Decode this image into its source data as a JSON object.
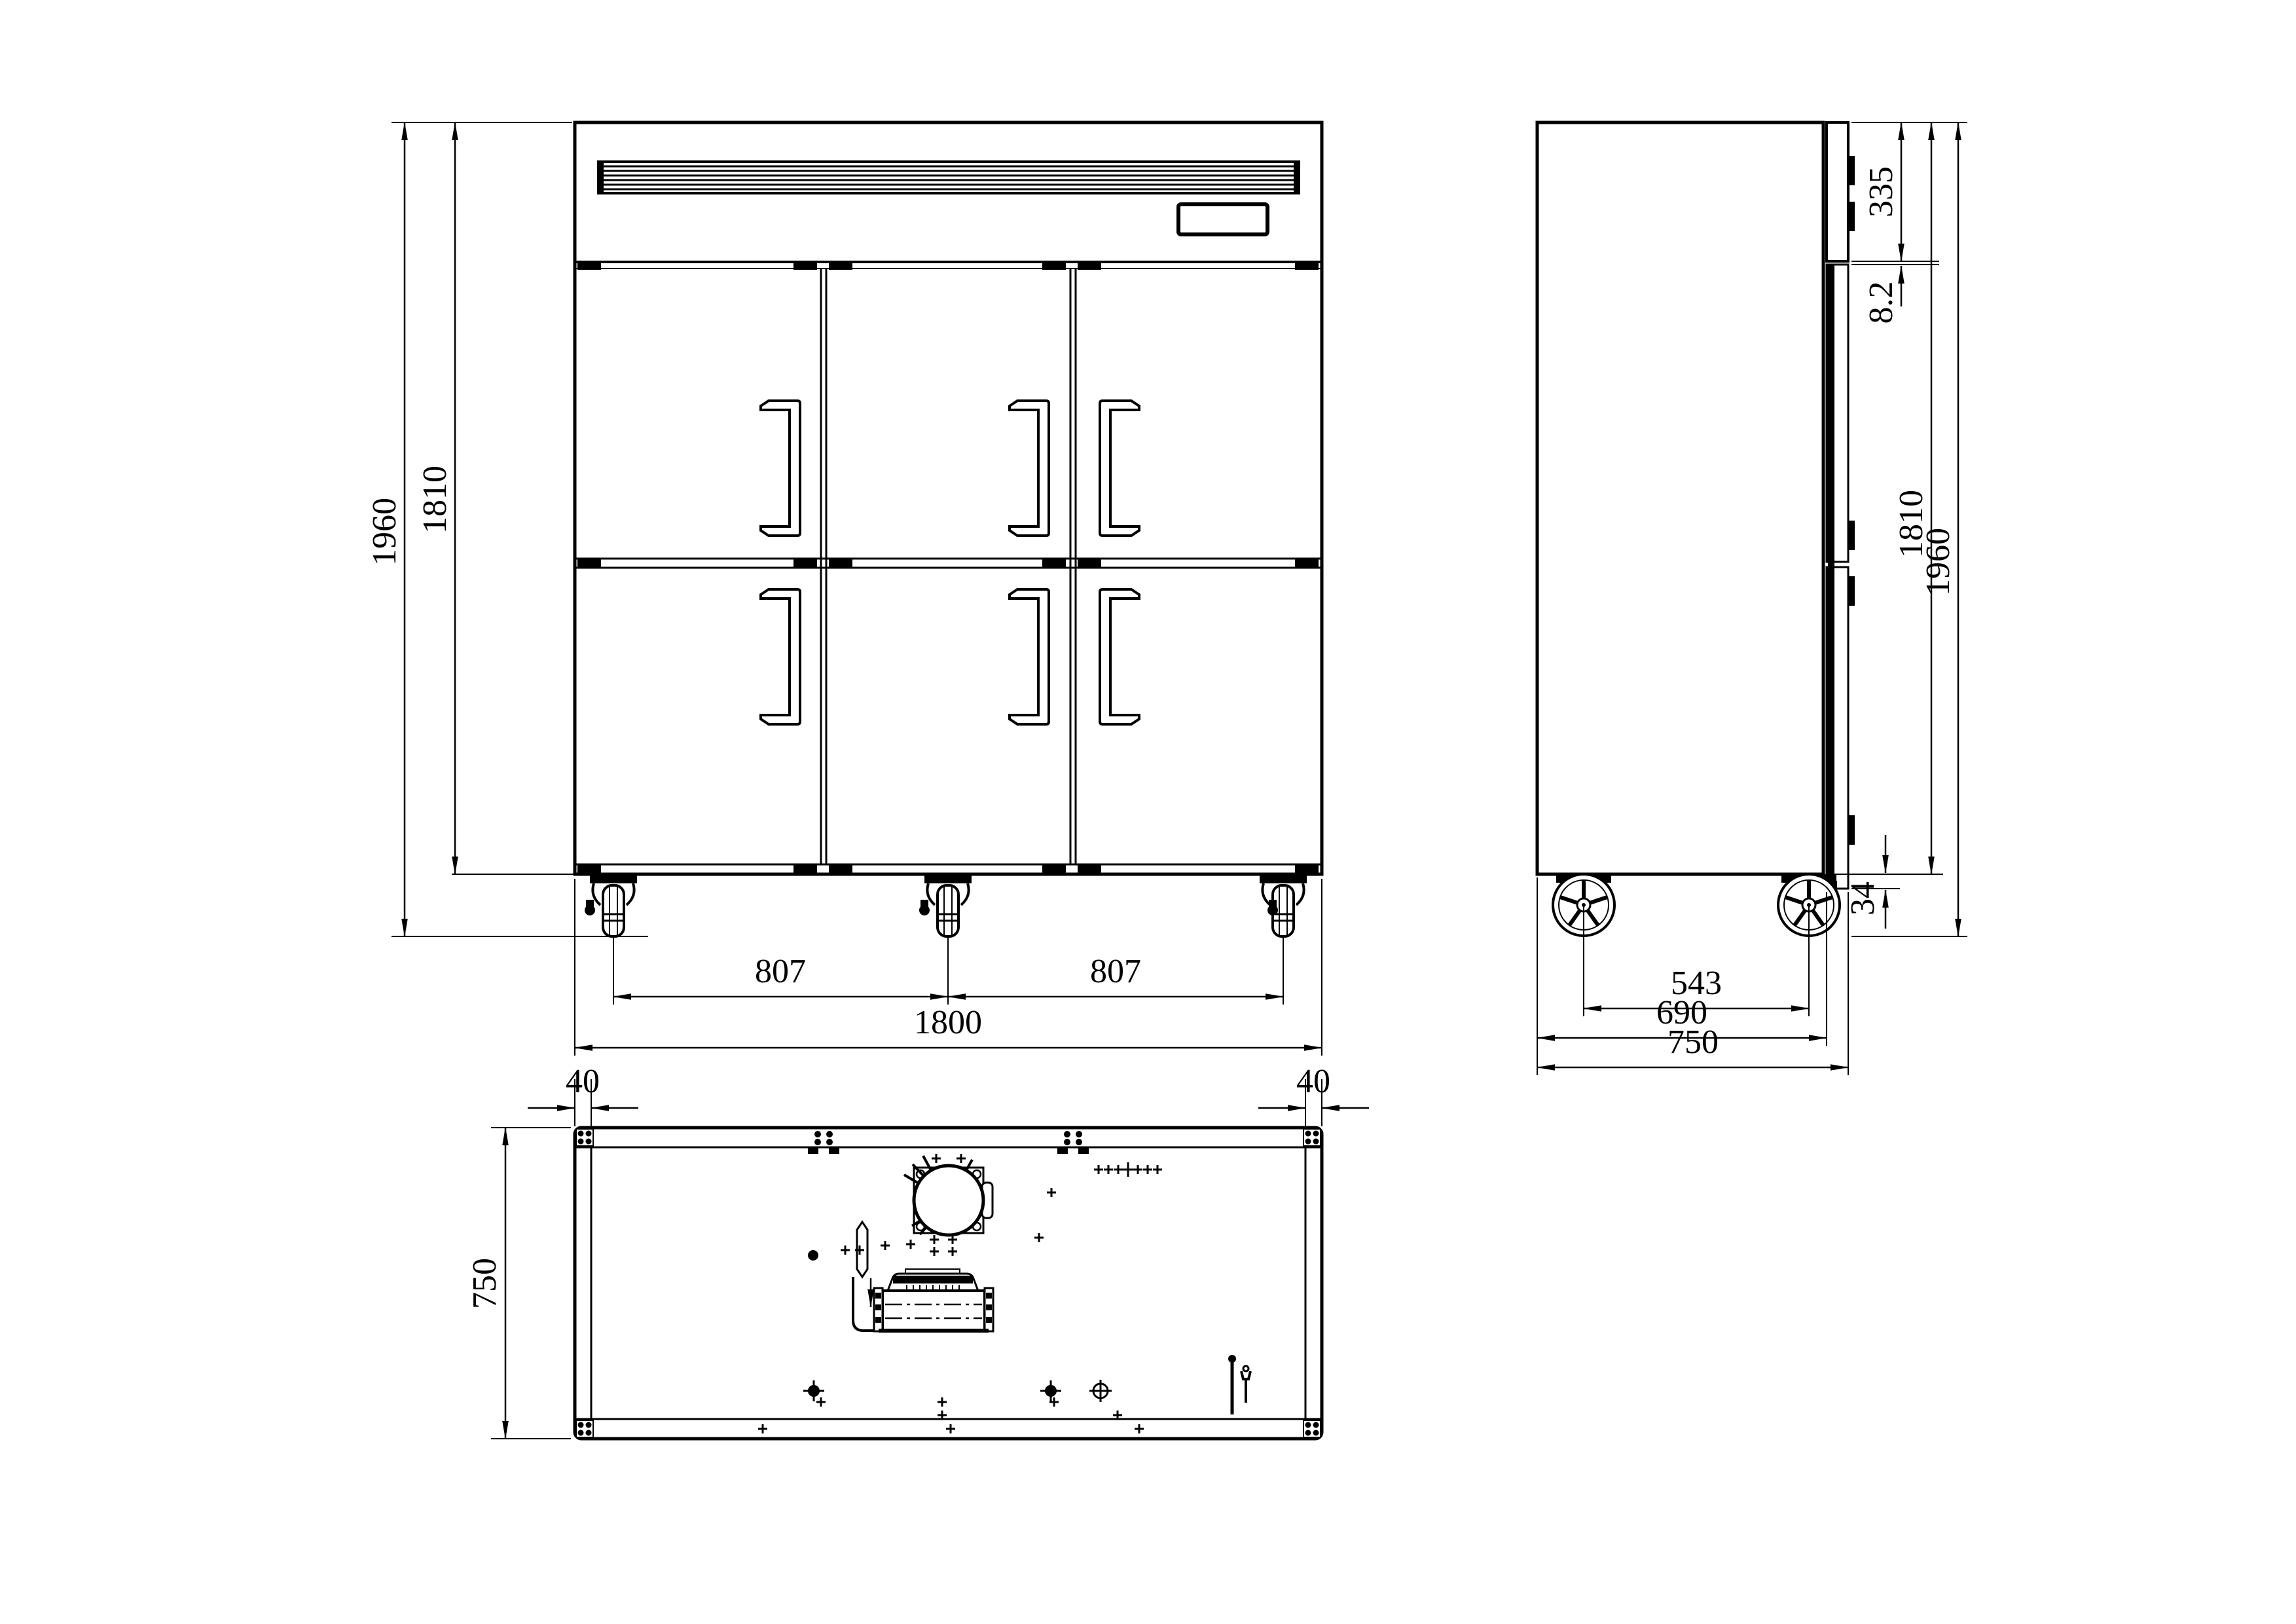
{
  "meta": {
    "drawing_type": "refrigerator-three-view-technical-drawing",
    "background_color": "#ffffff",
    "line_color": "#000000"
  },
  "front_view": {
    "dims": {
      "overall_height": "1960",
      "body_height": "1810",
      "caster_spacing_left": "807",
      "caster_spacing_right": "807",
      "overall_width": "1800"
    }
  },
  "side_view": {
    "dims": {
      "top_panel_height": "335",
      "panel_door_gap": "8.2",
      "body_height": "1810",
      "overall_height": "1960",
      "door_bottom_offset": "34",
      "caster_spacing": "543",
      "body_depth": "690",
      "overall_depth": "750"
    }
  },
  "plan_view": {
    "dims": {
      "left_edge_offset": "40",
      "right_edge_offset": "40",
      "depth": "750"
    }
  }
}
